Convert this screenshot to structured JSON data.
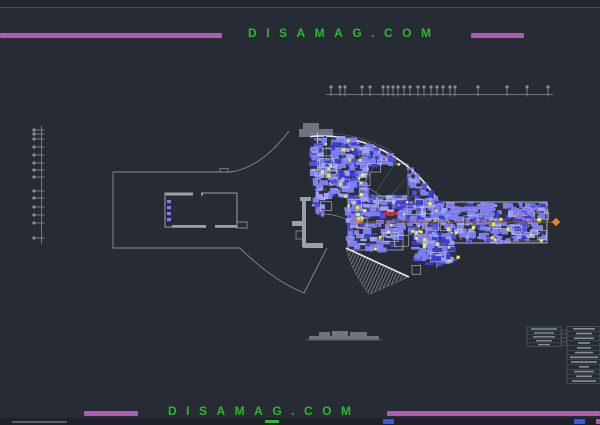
{
  "watermark": {
    "text": "DISAMAG.COM",
    "text_color": "#2db82d",
    "bar_color": "#b05ab4"
  },
  "drawing": {
    "colors": {
      "bg": "#262b34",
      "site_line": "#878d96",
      "wall": "#9aa0a8",
      "bright": "#e6eaf1",
      "building_base": "#2a3140",
      "room_blue": "#7d7df0",
      "room_blue_dark": "#5151d8",
      "room_blue_light": "#9f9ff4",
      "room_deep_blue": "#3d3dc8",
      "accent_yellow": "#f1ef38",
      "accent_red": "#d93a3a",
      "accent_cyan": "#43d8e8",
      "axis_orange_line": "#9a5c14",
      "axis_orange_marker": "#e2872a",
      "ruler": "#8a9098",
      "hatch": "#969ca6",
      "roof_gray": "#6f757e",
      "table_line": "#565c66",
      "table_text": "#8a9099"
    },
    "top_axis": {
      "y": 94.5,
      "x1": 326,
      "x2": 553,
      "ticks": [
        331,
        340,
        345,
        362,
        370,
        383,
        388,
        393,
        398,
        404,
        410,
        418,
        424,
        431,
        437,
        443,
        450,
        455,
        478,
        507,
        527,
        548
      ]
    },
    "left_axis": {
      "x": 41.5,
      "y1": 126,
      "y2": 244,
      "ticks": [
        130,
        134,
        139,
        147,
        155,
        163,
        170,
        177,
        191,
        198,
        207,
        215,
        223,
        238
      ]
    },
    "orange_axis": {
      "y": 222,
      "x1": 357,
      "x2": 556
    },
    "fan": {
      "cx": 322,
      "cy": 272,
      "outer_r": 136,
      "mid_r": 96,
      "core_r": 58,
      "a1": -95,
      "a2": -4
    },
    "room_counts": {
      "outer_band": 400,
      "mid_band": 150,
      "keel": 120,
      "wing": 240
    },
    "accent_counts": {
      "yellow": 68,
      "red": 8,
      "cyan": 8,
      "outline_rooms": 30,
      "deep_blocks": 20
    }
  },
  "title_block": {
    "left_rows": 5,
    "right_rows": 12,
    "mini_cells": 4
  }
}
